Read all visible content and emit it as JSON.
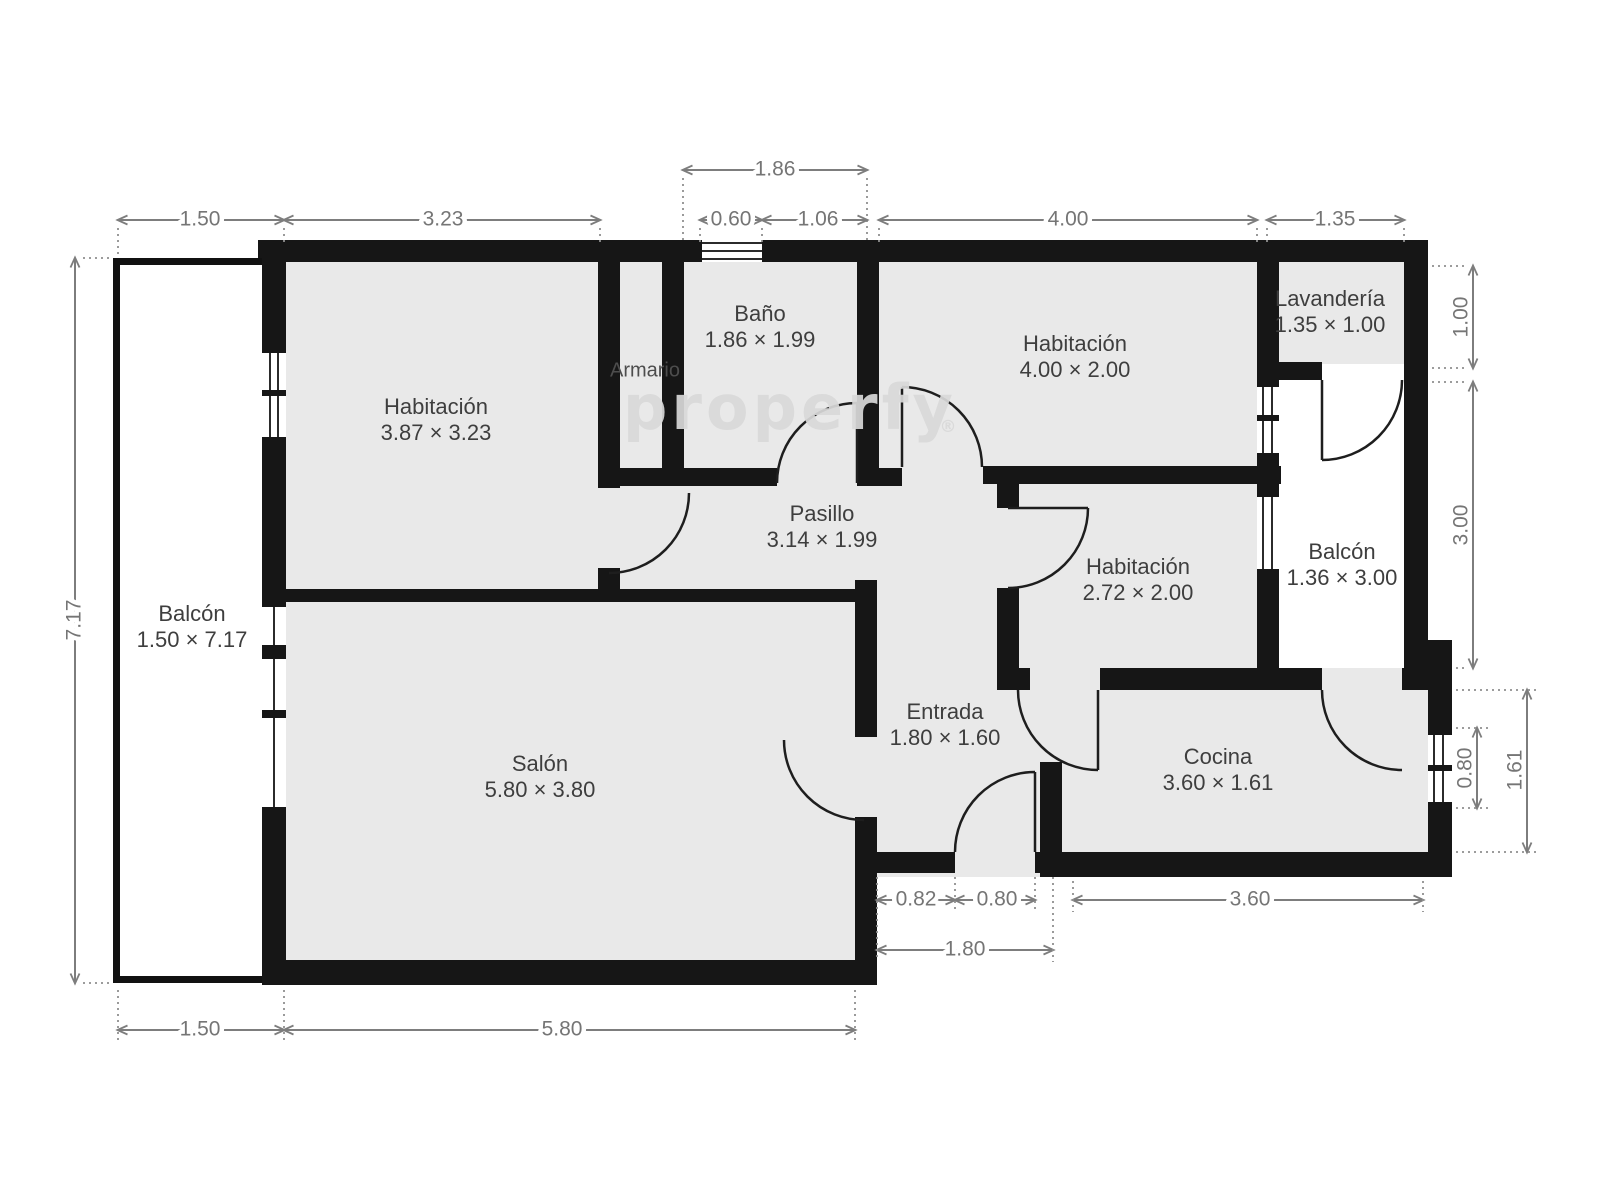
{
  "watermark": {
    "text": "properfy",
    "registered": "®"
  },
  "rooms": {
    "habitacion_tl": {
      "name": "Habitación",
      "dims": "3.87 × 3.23"
    },
    "bano": {
      "name": "Baño",
      "dims": "1.86 × 1.99"
    },
    "armario": {
      "name": "Armario"
    },
    "habitacion_tr": {
      "name": "Habitación",
      "dims": "4.00 × 2.00"
    },
    "lavanderia": {
      "name": "Lavandería",
      "dims": "1.35 × 1.00"
    },
    "pasillo": {
      "name": "Pasillo",
      "dims": "3.14 × 1.99"
    },
    "habitacion_mr": {
      "name": "Habitación",
      "dims": "2.72 × 2.00"
    },
    "balcon_right": {
      "name": "Balcón",
      "dims": "1.36 × 3.00"
    },
    "balcon_left": {
      "name": "Balcón",
      "dims": "1.50 × 7.17"
    },
    "salon": {
      "name": "Salón",
      "dims": "5.80 × 3.80"
    },
    "entrada": {
      "name": "Entrada",
      "dims": "1.80 × 1.60"
    },
    "cocina": {
      "name": "Cocina",
      "dims": "3.60 × 1.61"
    }
  },
  "dims": {
    "top_1_86": "1.86",
    "top_1_50": "1.50",
    "top_3_23": "3.23",
    "top_0_60": "0.60",
    "top_1_06": "1.06",
    "top_4_00": "4.00",
    "top_1_35": "1.35",
    "left_7_17": "7.17",
    "right_1_00": "1.00",
    "right_3_00": "3.00",
    "right_0_80": "0.80",
    "right_1_61": "1.61",
    "bottom_0_82": "0.82",
    "bottom_0_80": "0.80",
    "bottom_3_60": "3.60",
    "bottom_1_80": "1.80",
    "bottom_1_50": "1.50",
    "bottom_5_80": "5.80"
  },
  "colors": {
    "wall": "#161616",
    "room_fill": "#e9e9e9",
    "dimension": "#7d7d7d",
    "label": "#3e3e3e",
    "watermark": "#d9d9d9"
  }
}
